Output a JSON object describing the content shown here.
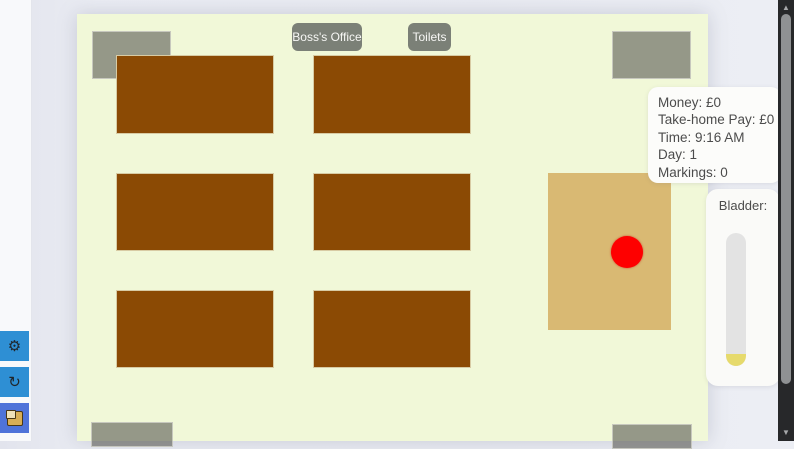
{
  "room_labels": {
    "boss_office": "Boss's Office",
    "toilets": "Toilets"
  },
  "stats_panel": {
    "lines": [
      "Money: £0",
      "Take-home Pay: £0",
      "Time: 9:16 AM",
      "Day: 1",
      "Markings: 0"
    ]
  },
  "bladder": {
    "label": "Bladder:",
    "fill_percent": 9,
    "fill_color": "#e6da6c"
  },
  "sidebar": {
    "buttons": [
      {
        "icon": "gear-icon",
        "glyph": "⚙",
        "color": "#2e8fd4"
      },
      {
        "icon": "hook-icon",
        "glyph": "↻",
        "color": "#2e8fd4"
      },
      {
        "icon": "package-icon",
        "glyph": "",
        "color": "#4f73d9"
      }
    ]
  },
  "scrollbar": {
    "up_glyph": "▲",
    "down_glyph": "▼"
  },
  "colors": {
    "game_floor": "#f1f8d8",
    "desk_brown": "#8b4a04",
    "grey_zone": "#5f5f58",
    "rug_tan": "#d9b973",
    "player_red": "#fe0000",
    "panel_bg": "#fcfcfa",
    "scrollbar_track": "#27282a"
  }
}
